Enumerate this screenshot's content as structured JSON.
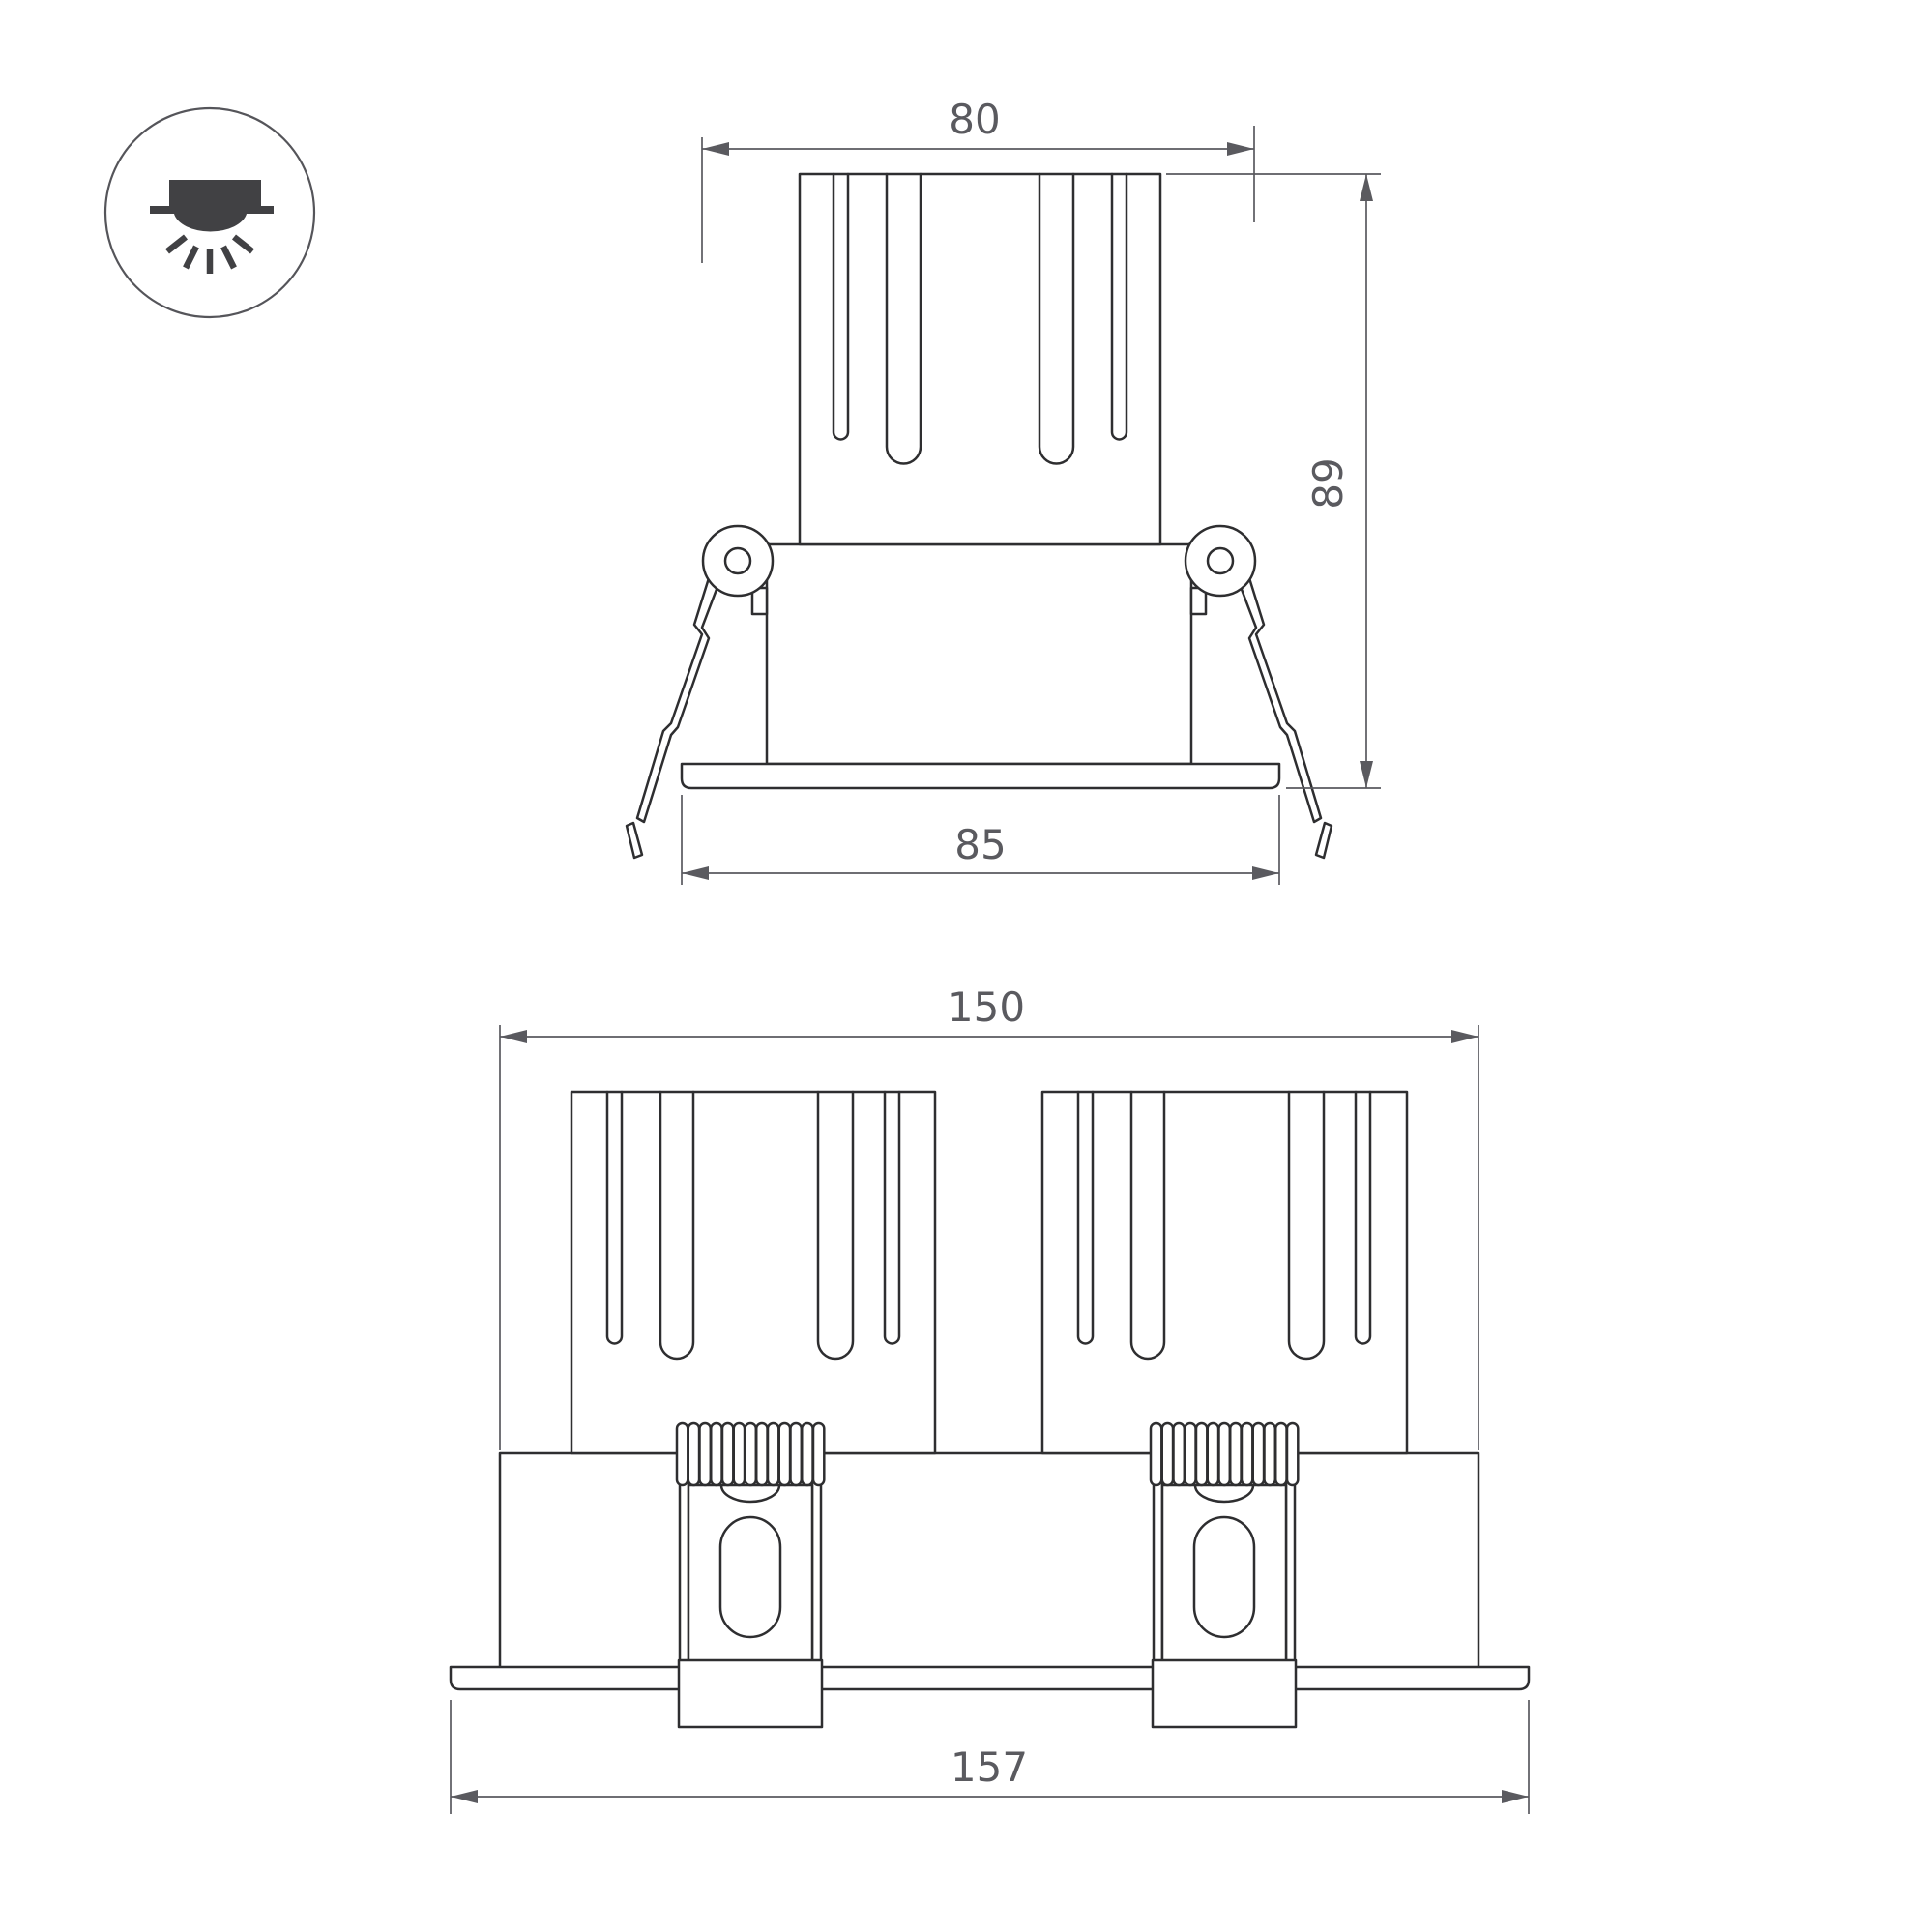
{
  "icon": {
    "name": "recessed-downlight-icon"
  },
  "views": {
    "single": {
      "dim_top_width": "80",
      "dim_height": "89",
      "dim_flange_width": "85"
    },
    "double": {
      "dim_overall_width": "150",
      "dim_flange_width": "157"
    }
  },
  "colors": {
    "background": "#ffffff",
    "part_line": "#2e2e30",
    "dimension": "#5a5a5f",
    "icon": "#414144"
  }
}
